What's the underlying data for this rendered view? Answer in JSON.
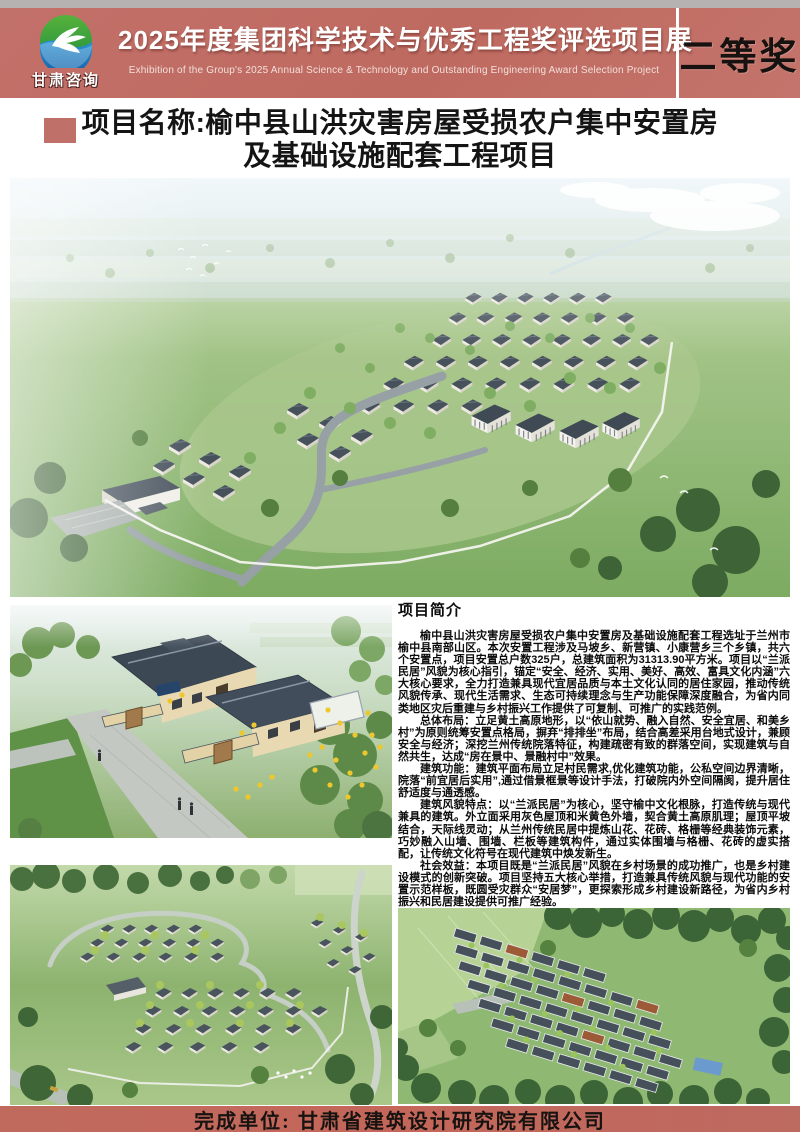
{
  "header": {
    "logo_label": "甘肃咨询",
    "logo_icon": "swan-bird-circle-icon",
    "title_cn": "2025年度集团科学技术与优秀工程奖评选项目展",
    "title_en": "Exhibition of the Group's 2025 Annual Science & Technology and Outstanding Engineering Award Selection Project",
    "award_label": "二等奖"
  },
  "project": {
    "title_line1": "项目名称:榆中县山洪灾害房屋受损农户集中安置房",
    "title_line2": "及基础设施配套工程项目"
  },
  "intro": {
    "heading": "项目简介",
    "paragraphs": [
      "榆中县山洪灾害房屋受损农户集中安置房及基础设施配套工程选址于兰州市榆中县南部山区。本次安置工程涉及马坡乡、新营镇、小康营乡三个乡镇，共六个安置点，项目安置总户数325户，总建筑面积为31313.90平方米。项目以“兰派民居”风貌为核心指引，锚定“安全、经济、实用、美好、高效、富具文化内涵”六大核心要求，全力打造兼具现代宜居品质与本土文化认同的居住家园，推动传统风貌传承、现代生活需求、生态可持续理念与生产功能保障深度融合，为省内同类地区灾后重建与乡村振兴工作提供了可复制、可推广的实践范例。",
      "总体布局：立足黄土高原地形，以“依山就势、融入自然、安全宜居、和美乡村”为原则统筹安置点格局，摒弃“排排坐”布局，结合高差采用台地式设计，兼顾安全与经济；深挖兰州传统院落特征，构建疏密有致的群落空间，实现建筑与自然共生，达成“房在景中、景融村中”效果。",
      "建筑功能：建筑平面布局立足村民需求,优化建筑功能，公私空间边界清晰，院落“前宜居后实用”,通过借景框景等设计手法，打破院内外空间隔阂，提升居住舒适度与通透感。",
      "建筑风貌特点：以“兰派民居”为核心，坚守榆中文化根脉，打造传统与现代兼具的建筑。外立面采用灰色屋顶和米黄色外墙，契合黄土高原肌理；屋顶平坡结合，天际线灵动；从兰州传统民居中提炼山花、花砖、格栅等经典装饰元素，巧妙融入山墙、围墙、栏板等建筑构件，通过实体围墙与格栅、花砖的虚实搭配，让传统文化符号在现代建筑中焕发新生。",
      "社会效益：本项目既是“兰派民居”风貌在乡村场景的成功推广，也是乡村建设模式的创新突破。项目坚持五大核心举措，打造兼具传统风貌与现代功能的安置示范样板，既圆受灾群众“安居梦”，更探索形成乡村建设新路径，为省内乡村振兴和民居建设提供可推广经验。"
    ]
  },
  "footer": {
    "completed_by": "完成单位: 甘肃省建筑设计研究院有限公司"
  },
  "colors": {
    "header_red": "#c06d63",
    "footer_red": "#c2685c",
    "strip_gray": "#b6b2b1",
    "accent_square": "#bf7068"
  }
}
